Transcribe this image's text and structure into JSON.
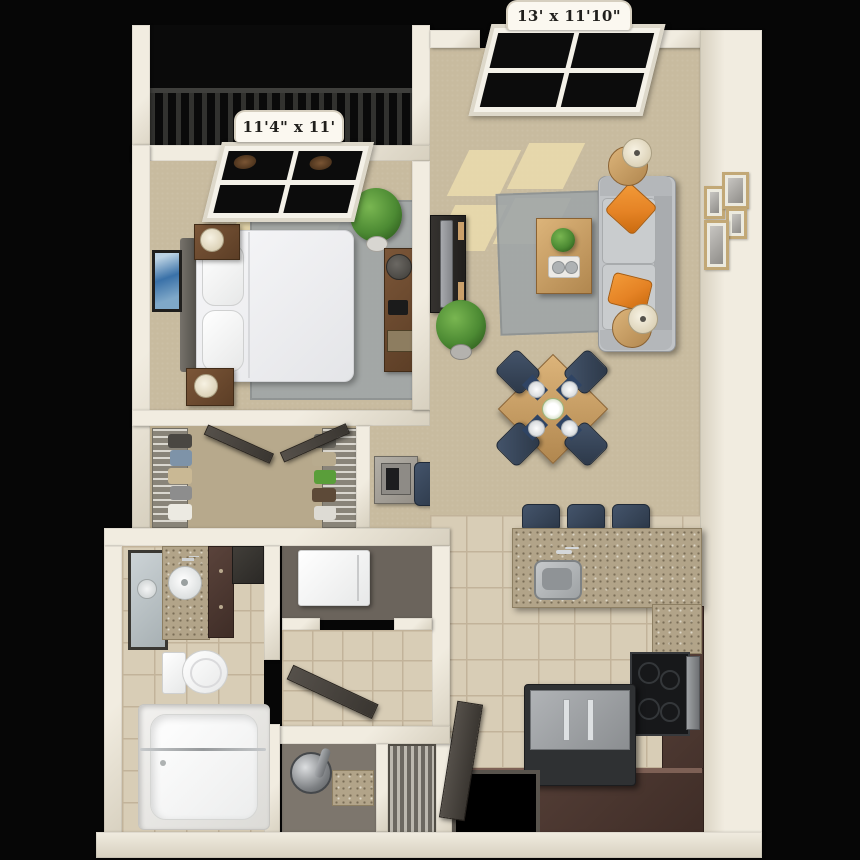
{
  "labels": {
    "bedroom_dimensions": "11'4\" x 11'",
    "living_room_dimensions": "13' x 11'10\""
  },
  "rooms": [
    "balcony",
    "bedroom",
    "walk-in-closet",
    "desk-nook",
    "living-room",
    "dining-area",
    "kitchen",
    "breakfast-bar",
    "laundry-closet",
    "hallway",
    "utility-closet",
    "bathroom",
    "entry"
  ],
  "palette": {
    "background": "#060606",
    "wall": "#f1ece0",
    "wall_shade": "#d7d0bf",
    "carpet": "#c8bb9f",
    "carpet_dark": "#b7a98c",
    "tile": "#d8cdb6",
    "tile_line": "#c2b39a",
    "rug": "#9da4a8",
    "wood": "#dcb47a",
    "wood_dark": "#b1874f",
    "brown": "#7b5638",
    "cabinet": "#5a433b",
    "cabinet_dark": "#3f2d27",
    "sofa": "#c1c4c7",
    "sofa_dark": "#a9acaf",
    "orange": "#e58325",
    "navy": "#44546b",
    "navy_dark": "#2c3848",
    "granite": "#b2a489",
    "charcoal": "#2c2a28",
    "metal": "#9fa3a6",
    "plant": "#4c8a33",
    "plant_dark": "#2b581b",
    "sunlight": "#eedfae",
    "glass": "#0c0c0c",
    "label_bg": "#fbf8f0",
    "label_text": "#201f1c"
  }
}
